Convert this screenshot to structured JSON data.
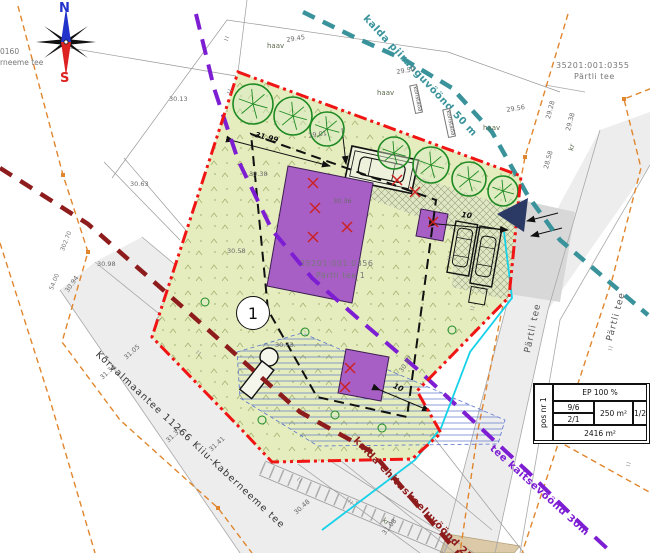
{
  "compass": {
    "north": "N",
    "south": "S"
  },
  "corner_texts": {
    "left_line1": "0160",
    "left_line2": "rneeme tee"
  },
  "parcels": {
    "p355": {
      "code": "35201:001:0355",
      "name": "Pärtli tee"
    },
    "p356": {
      "code": "35201:001:0356",
      "name": "Pärtli tee 1"
    }
  },
  "roads": {
    "main": "Kõrvalmaantee 11266 Kiiu-Kaberneeme tee",
    "side": "Pärtli tee",
    "side2": "Pärtli tee"
  },
  "zones": {
    "shore_limit": {
      "label": "kalda piiranguvöönd 50 m",
      "color": "#3a939b"
    },
    "shore_ban": {
      "label": "kalda ehituskeeluvöönd 25m",
      "color": "#8e1c1c"
    },
    "road_protect": {
      "label": "tee kaitsevöönd 30m",
      "color": "#7d1ed2"
    }
  },
  "pos_marker": "1",
  "info_table": {
    "pos": "pos nr 1",
    "ep": "EP 100 %",
    "r1a": "9/6",
    "r1b": "2/1",
    "area": "250 m²",
    "ratio": "1/2",
    "total": "2416 m²"
  },
  "colors": {
    "plot_fill": "#e5edbe",
    "boundary_red": "#f01414",
    "building_purple": "#a75fc6",
    "shore_limit_teal": "#3a939b",
    "shore_ban_maroon": "#8e1c1c",
    "road_protect_violet": "#7d1ed2",
    "cadastral_orange": "#e0862e",
    "waterline_cyan": "#16d2e8",
    "access_navy": "#2b3a64"
  },
  "annotations": {
    "dimensions": [
      {
        "t": "31.99",
        "x": 256,
        "y": 131,
        "r": 14
      },
      {
        "t": "10",
        "x": 462,
        "y": 211,
        "r": 8
      },
      {
        "t": "10",
        "x": 395,
        "y": 382,
        "r": 25
      }
    ],
    "elevations": [
      {
        "t": "29.45",
        "x": 286,
        "y": 37,
        "r": -9
      },
      {
        "t": "29.50",
        "x": 396,
        "y": 69,
        "r": -9
      },
      {
        "t": "30.13",
        "x": 169,
        "y": 96,
        "r": 0
      },
      {
        "t": "29.01",
        "x": 308,
        "y": 133,
        "r": -9
      },
      {
        "t": "30.63",
        "x": 130,
        "y": 181,
        "r": 0
      },
      {
        "t": "30.98",
        "x": 97,
        "y": 261,
        "r": 0
      },
      {
        "t": "30.94",
        "x": 64,
        "y": 290,
        "r": -55
      },
      {
        "t": "30.38",
        "x": 249,
        "y": 171,
        "r": 0
      },
      {
        "t": "30.36",
        "x": 333,
        "y": 198,
        "r": 0
      },
      {
        "t": "30.58",
        "x": 227,
        "y": 248,
        "r": 0
      },
      {
        "t": "30.73",
        "x": 275,
        "y": 342,
        "r": 0
      },
      {
        "t": "30.47",
        "x": 398,
        "y": 370,
        "r": -55
      },
      {
        "t": "29.56",
        "x": 506,
        "y": 107,
        "r": -9
      },
      {
        "t": "29.28",
        "x": 545,
        "y": 118,
        "r": -75
      },
      {
        "t": "29.38",
        "x": 565,
        "y": 130,
        "r": -75
      },
      {
        "t": "28.58",
        "x": 543,
        "y": 168,
        "r": -75
      },
      {
        "t": "31.05",
        "x": 123,
        "y": 356,
        "r": -42
      },
      {
        "t": "31.34",
        "x": 99,
        "y": 376,
        "r": -42
      },
      {
        "t": "31.31",
        "x": 165,
        "y": 439,
        "r": -42
      },
      {
        "t": "31.41",
        "x": 208,
        "y": 448,
        "r": -42
      },
      {
        "t": "30.48",
        "x": 293,
        "y": 511,
        "r": -42
      },
      {
        "t": "31.08",
        "x": 381,
        "y": 532,
        "r": -50
      }
    ],
    "small_labels": [
      {
        "t": "302.70",
        "x": 60,
        "y": 250,
        "r": -68
      },
      {
        "t": "54.00",
        "x": 49,
        "y": 289,
        "r": -68
      }
    ],
    "notes": [
      {
        "t": "haav",
        "x": 267,
        "y": 43,
        "r": 0
      },
      {
        "t": "haav",
        "x": 377,
        "y": 90,
        "r": 0
      },
      {
        "t": "haav",
        "x": 483,
        "y": 125,
        "r": 0
      },
      {
        "t": "kr",
        "x": 568,
        "y": 150,
        "r": -75
      },
      {
        "t": "kr",
        "x": 385,
        "y": 517,
        "r": 40
      }
    ],
    "tree_tags": [
      {
        "t": "koristada",
        "x": 417,
        "y": 84,
        "r": 78
      },
      {
        "t": "koristada",
        "x": 450,
        "y": 108,
        "r": 78
      }
    ]
  },
  "map": {
    "tick_glyph": "II",
    "ticks": [
      {
        "x": 224,
        "y": 40,
        "r": -70
      },
      {
        "x": 227,
        "y": 93,
        "r": -70
      },
      {
        "x": 158,
        "y": 316,
        "r": 42
      },
      {
        "x": 198,
        "y": 350,
        "r": 42
      },
      {
        "x": 299,
        "y": 477,
        "r": 42
      },
      {
        "x": 350,
        "y": 499,
        "r": 42
      },
      {
        "x": 447,
        "y": 260,
        "r": -75
      },
      {
        "x": 608,
        "y": 350,
        "r": -75
      },
      {
        "x": 626,
        "y": 466,
        "r": -75
      },
      {
        "x": 470,
        "y": 310,
        "r": -75
      }
    ],
    "trees": [
      {
        "x": 253,
        "y": 104,
        "r": 20
      },
      {
        "x": 293,
        "y": 116,
        "r": 19
      },
      {
        "x": 327,
        "y": 129,
        "r": 17
      },
      {
        "x": 394,
        "y": 153,
        "r": 16
      },
      {
        "x": 431,
        "y": 165,
        "r": 18
      },
      {
        "x": 469,
        "y": 179,
        "r": 17
      },
      {
        "x": 503,
        "y": 191,
        "r": 15
      },
      {
        "x": 305,
        "y": 332,
        "r": 4
      },
      {
        "x": 205,
        "y": 302,
        "r": 4
      },
      {
        "x": 382,
        "y": 428,
        "r": 4
      },
      {
        "x": 335,
        "y": 415,
        "r": 4
      },
      {
        "x": 452,
        "y": 330,
        "r": 4
      },
      {
        "x": 262,
        "y": 420,
        "r": 4
      }
    ],
    "removed_trees": [
      {
        "x": 313,
        "y": 183
      },
      {
        "x": 315,
        "y": 208
      },
      {
        "x": 313,
        "y": 237
      },
      {
        "x": 347,
        "y": 227
      },
      {
        "x": 397,
        "y": 180
      },
      {
        "x": 415,
        "y": 192
      },
      {
        "x": 433,
        "y": 222
      },
      {
        "x": 350,
        "y": 368
      },
      {
        "x": 345,
        "y": 387
      }
    ]
  }
}
